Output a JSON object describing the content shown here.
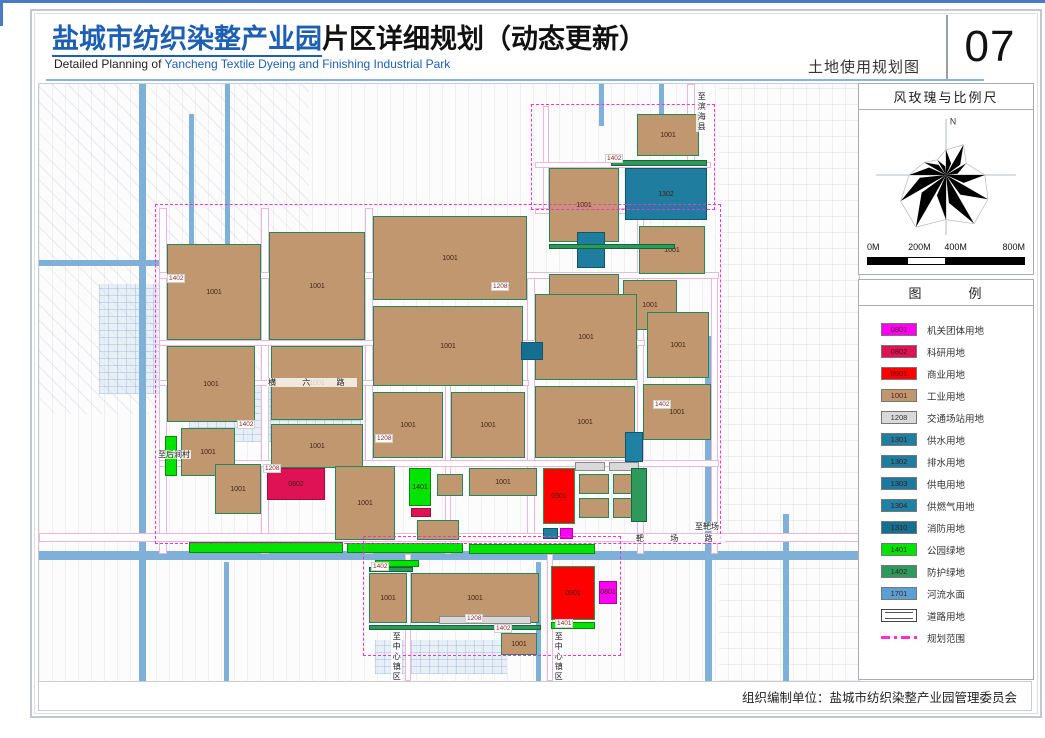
{
  "header": {
    "title_highlight": "盐城市纺织染整产业园",
    "title_rest": "片区详细规划（动态更新）",
    "subtitle_prefix": "Detailed Planning of ",
    "subtitle_highlight": "Yancheng Textile Dyeing and Finishing Industrial Park",
    "sheet_label": "土地使用规划图",
    "sheet_number": "07"
  },
  "windrose": {
    "title": "风玫瑰与比例尺",
    "north_label": "N",
    "scale_labels": [
      "0M",
      "200M",
      "400M",
      "800M"
    ],
    "petal_radii": [
      26,
      36,
      24,
      40,
      50,
      58,
      46,
      62,
      54,
      38,
      26,
      18
    ]
  },
  "legend": {
    "title": "图　　　例",
    "items": [
      {
        "code": "0801",
        "label": "机关团体用地",
        "color": "#ff00f0"
      },
      {
        "code": "0802",
        "label": "科研用地",
        "color": "#e01256"
      },
      {
        "code": "0901",
        "label": "商业用地",
        "color": "#ff0000"
      },
      {
        "code": "1001",
        "label": "工业用地",
        "color": "#c0976f"
      },
      {
        "code": "1208",
        "label": "交通场站用地",
        "color": "#d9d9d9"
      },
      {
        "code": "1301",
        "label": "供水用地",
        "color": "#207fa1"
      },
      {
        "code": "1302",
        "label": "排水用地",
        "color": "#1f7da0"
      },
      {
        "code": "1303",
        "label": "供电用地",
        "color": "#1d7a9e"
      },
      {
        "code": "1304",
        "label": "供燃气用地",
        "color": "#1f81a4"
      },
      {
        "code": "1310",
        "label": "消防用地",
        "color": "#156f90"
      },
      {
        "code": "1401",
        "label": "公园绿地",
        "color": "#00e400"
      },
      {
        "code": "1402",
        "label": "防护绿地",
        "color": "#2d9a5c"
      },
      {
        "code": "1701",
        "label": "河流水面",
        "color": "#5c9fd3"
      },
      {
        "code": "",
        "label": "道路用地",
        "type": "road"
      },
      {
        "code": "",
        "label": "规划范围",
        "type": "boundary"
      }
    ]
  },
  "map": {
    "colors": {
      "0801": "#ff00f0",
      "0802": "#e01256",
      "0901": "#ff0000",
      "1001": "#c0976f",
      "1208": "#d9d9d9",
      "1301": "#207fa1",
      "1302": "#1f7da0",
      "1303": "#1d7a9e",
      "1304": "#1f81a4",
      "1310": "#156f90",
      "1401": "#00e400",
      "1402": "#2d9a5c",
      "1701": "#5c9fd3"
    },
    "borders": {
      "1001": "#1f8a55",
      "1401": "#0a8a0a",
      "1402": "#14643c",
      "0901": "#17a24a",
      "0802": "#a50d42",
      "0801": "#b000b0",
      "1208": "#8a8a8a",
      "1301": "#0d566e",
      "1302": "#0d566e",
      "1303": "#0d566e",
      "1304": "#0d566e",
      "1310": "#0d566e",
      "1701": "#33709e"
    },
    "fields": [
      {
        "x": 0,
        "y": 0,
        "w": 270,
        "h": 330,
        "kind": "diag"
      },
      {
        "x": 680,
        "y": 0,
        "w": 140,
        "h": 597,
        "kind": "h"
      }
    ],
    "villages": [
      {
        "x": 150,
        "y": 302,
        "w": 172,
        "h": 56
      },
      {
        "x": 336,
        "y": 556,
        "w": 132,
        "h": 34
      },
      {
        "x": 60,
        "y": 200,
        "w": 60,
        "h": 110
      }
    ],
    "canals": [
      {
        "x": 100,
        "y": 0,
        "w": 7,
        "h": 597
      },
      {
        "x": 186,
        "y": 0,
        "w": 5,
        "h": 186
      },
      {
        "x": 0,
        "y": 176,
        "w": 190,
        "h": 6
      },
      {
        "x": 150,
        "y": 30,
        "w": 5,
        "h": 150
      },
      {
        "x": 0,
        "y": 467,
        "w": 820,
        "h": 9
      },
      {
        "x": 666,
        "y": 252,
        "w": 7,
        "h": 345
      },
      {
        "x": 744,
        "y": 430,
        "w": 6,
        "h": 167
      },
      {
        "x": 560,
        "y": 0,
        "w": 5,
        "h": 42
      },
      {
        "x": 620,
        "y": 0,
        "w": 5,
        "h": 62
      },
      {
        "x": 497,
        "y": 478,
        "w": 5,
        "h": 119
      },
      {
        "x": 185,
        "y": 478,
        "w": 5,
        "h": 119
      }
    ],
    "roads": [
      {
        "x": 648,
        "y": 0,
        "w": 8,
        "h": 134
      },
      {
        "x": 504,
        "y": 22,
        "w": 6,
        "h": 104
      },
      {
        "x": 496,
        "y": 78,
        "w": 176,
        "h": 6
      },
      {
        "x": 496,
        "y": 124,
        "w": 162,
        "h": 6
      },
      {
        "x": 120,
        "y": 124,
        "w": 8,
        "h": 346
      },
      {
        "x": 222,
        "y": 124,
        "w": 8,
        "h": 346
      },
      {
        "x": 326,
        "y": 124,
        "w": 8,
        "h": 346
      },
      {
        "x": 406,
        "y": 300,
        "w": 6,
        "h": 170
      },
      {
        "x": 488,
        "y": 190,
        "w": 8,
        "h": 280
      },
      {
        "x": 598,
        "y": 124,
        "w": 7,
        "h": 346
      },
      {
        "x": 672,
        "y": 190,
        "w": 7,
        "h": 280
      },
      {
        "x": 120,
        "y": 188,
        "w": 560,
        "h": 7
      },
      {
        "x": 120,
        "y": 256,
        "w": 486,
        "h": 6
      },
      {
        "x": 120,
        "y": 296,
        "w": 370,
        "h": 6
      },
      {
        "x": 120,
        "y": 376,
        "w": 560,
        "h": 7
      },
      {
        "x": 0,
        "y": 449,
        "w": 820,
        "h": 9
      },
      {
        "x": 366,
        "y": 470,
        "w": 6,
        "h": 127
      },
      {
        "x": 508,
        "y": 470,
        "w": 6,
        "h": 127
      }
    ],
    "boundary": [
      {
        "x": 116,
        "y": 120,
        "w": 566,
        "h": 340
      },
      {
        "x": 492,
        "y": 20,
        "w": 184,
        "h": 106
      },
      {
        "x": 324,
        "y": 452,
        "w": 258,
        "h": 120
      }
    ],
    "parcels": [
      {
        "c": "1001",
        "x": 598,
        "y": 30,
        "w": 62,
        "h": 42
      },
      {
        "c": "1402",
        "x": 572,
        "y": 76,
        "w": 96,
        "h": 6,
        "nl": 1
      },
      {
        "c": "1302",
        "x": 586,
        "y": 84,
        "w": 82,
        "h": 52
      },
      {
        "c": "1001",
        "x": 510,
        "y": 84,
        "w": 70,
        "h": 74
      },
      {
        "c": "1001",
        "x": 600,
        "y": 142,
        "w": 66,
        "h": 48
      },
      {
        "c": "1302",
        "x": 538,
        "y": 148,
        "w": 28,
        "h": 36,
        "nl": 1
      },
      {
        "c": "1402",
        "x": 510,
        "y": 160,
        "w": 126,
        "h": 5,
        "nl": 1
      },
      {
        "c": "1001",
        "x": 510,
        "y": 190,
        "w": 70,
        "h": 52
      },
      {
        "c": "1001",
        "x": 584,
        "y": 196,
        "w": 54,
        "h": 50
      },
      {
        "c": "1001",
        "x": 498,
        "y": 252,
        "w": 66,
        "h": 40
      },
      {
        "c": "1001",
        "x": 128,
        "y": 160,
        "w": 94,
        "h": 96
      },
      {
        "c": "1001",
        "x": 128,
        "y": 262,
        "w": 88,
        "h": 76
      },
      {
        "c": "1401",
        "x": 126,
        "y": 352,
        "w": 12,
        "h": 40,
        "nl": 1
      },
      {
        "c": "1001",
        "x": 142,
        "y": 344,
        "w": 54,
        "h": 48
      },
      {
        "c": "1001",
        "x": 230,
        "y": 148,
        "w": 96,
        "h": 108
      },
      {
        "c": "1001",
        "x": 334,
        "y": 132,
        "w": 154,
        "h": 84
      },
      {
        "c": "1001",
        "x": 334,
        "y": 222,
        "w": 150,
        "h": 80
      },
      {
        "c": "1001",
        "x": 496,
        "y": 210,
        "w": 102,
        "h": 86
      },
      {
        "c": "1310",
        "x": 482,
        "y": 258,
        "w": 22,
        "h": 18,
        "nl": 1
      },
      {
        "c": "1001",
        "x": 608,
        "y": 228,
        "w": 62,
        "h": 66
      },
      {
        "c": "1001",
        "x": 232,
        "y": 262,
        "w": 92,
        "h": 74
      },
      {
        "c": "1001",
        "x": 232,
        "y": 340,
        "w": 92,
        "h": 44
      },
      {
        "c": "1001",
        "x": 334,
        "y": 308,
        "w": 70,
        "h": 66
      },
      {
        "c": "1001",
        "x": 412,
        "y": 308,
        "w": 74,
        "h": 66
      },
      {
        "c": "1001",
        "x": 496,
        "y": 302,
        "w": 100,
        "h": 72
      },
      {
        "c": "1001",
        "x": 604,
        "y": 300,
        "w": 68,
        "h": 56
      },
      {
        "c": "1304",
        "x": 586,
        "y": 348,
        "w": 18,
        "h": 30,
        "nl": 1
      },
      {
        "c": "1001",
        "x": 176,
        "y": 380,
        "w": 46,
        "h": 50
      },
      {
        "c": "0802",
        "x": 228,
        "y": 384,
        "w": 58,
        "h": 32
      },
      {
        "c": "1001",
        "x": 296,
        "y": 382,
        "w": 60,
        "h": 74
      },
      {
        "c": "1401",
        "x": 370,
        "y": 384,
        "w": 22,
        "h": 38
      },
      {
        "c": "0802",
        "x": 372,
        "y": 424,
        "w": 20,
        "h": 9,
        "nl": 1
      },
      {
        "c": "1001",
        "x": 398,
        "y": 390,
        "w": 26,
        "h": 22,
        "nl": 1
      },
      {
        "c": "1001",
        "x": 430,
        "y": 384,
        "w": 68,
        "h": 28
      },
      {
        "c": "1001",
        "x": 378,
        "y": 436,
        "w": 42,
        "h": 20,
        "nl": 1
      },
      {
        "c": "0901",
        "x": 504,
        "y": 384,
        "w": 32,
        "h": 56
      },
      {
        "c": "1301",
        "x": 504,
        "y": 444,
        "w": 15,
        "h": 11,
        "nl": 1
      },
      {
        "c": "0801",
        "x": 521,
        "y": 444,
        "w": 13,
        "h": 11,
        "nl": 1
      },
      {
        "c": "1001",
        "x": 540,
        "y": 390,
        "w": 30,
        "h": 20,
        "nl": 1
      },
      {
        "c": "1001",
        "x": 574,
        "y": 390,
        "w": 28,
        "h": 20,
        "nl": 1
      },
      {
        "c": "1001",
        "x": 540,
        "y": 414,
        "w": 30,
        "h": 20,
        "nl": 1
      },
      {
        "c": "1001",
        "x": 574,
        "y": 414,
        "w": 28,
        "h": 20,
        "nl": 1
      },
      {
        "c": "1208",
        "x": 536,
        "y": 378,
        "w": 30,
        "h": 9,
        "nl": 1
      },
      {
        "c": "1208",
        "x": 570,
        "y": 378,
        "w": 30,
        "h": 9,
        "nl": 1
      },
      {
        "c": "1402",
        "x": 592,
        "y": 384,
        "w": 16,
        "h": 54,
        "nl": 1
      },
      {
        "c": "1401",
        "x": 150,
        "y": 458,
        "w": 154,
        "h": 11,
        "nl": 1
      },
      {
        "c": "1401",
        "x": 308,
        "y": 459,
        "w": 116,
        "h": 10,
        "nl": 1
      },
      {
        "c": "1401",
        "x": 430,
        "y": 460,
        "w": 126,
        "h": 10,
        "nl": 1
      },
      {
        "c": "1401",
        "x": 336,
        "y": 476,
        "w": 44,
        "h": 7,
        "nl": 1
      },
      {
        "c": "1402",
        "x": 330,
        "y": 483,
        "w": 44,
        "h": 5,
        "nl": 1
      },
      {
        "c": "1001",
        "x": 330,
        "y": 489,
        "w": 38,
        "h": 50
      },
      {
        "c": "1001",
        "x": 372,
        "y": 489,
        "w": 128,
        "h": 50
      },
      {
        "c": "1208",
        "x": 400,
        "y": 532,
        "w": 92,
        "h": 8,
        "nl": 1
      },
      {
        "c": "1402",
        "x": 330,
        "y": 541,
        "w": 172,
        "h": 5,
        "nl": 1
      },
      {
        "c": "1001",
        "x": 462,
        "y": 549,
        "w": 36,
        "h": 22
      },
      {
        "c": "0901",
        "x": 512,
        "y": 482,
        "w": 44,
        "h": 54
      },
      {
        "c": "0801",
        "x": 560,
        "y": 497,
        "w": 18,
        "h": 23
      },
      {
        "c": "1401",
        "x": 512,
        "y": 538,
        "w": 44,
        "h": 7,
        "nl": 1
      }
    ],
    "labels": [
      {
        "t": "至滨海县",
        "x": 657,
        "y": 8,
        "v": 1
      },
      {
        "t": "至后涧村",
        "x": 118,
        "y": 366
      },
      {
        "t": "横  六  路",
        "x": 228,
        "y": 294,
        "sp": 1
      },
      {
        "t": "靶  场  路",
        "x": 596,
        "y": 450,
        "sp": 1
      },
      {
        "t": "至靶场",
        "x": 655,
        "y": 438
      },
      {
        "t": "至中心镇区",
        "x": 352,
        "y": 548,
        "v": 1
      },
      {
        "t": "至中心镇区",
        "x": 514,
        "y": 548,
        "v": 1
      },
      {
        "t": "1402",
        "x": 566,
        "y": 70,
        "chip": 1
      },
      {
        "t": "1402",
        "x": 128,
        "y": 190,
        "chip": 1
      },
      {
        "t": "1402",
        "x": 198,
        "y": 336,
        "chip": 1
      },
      {
        "t": "1402",
        "x": 332,
        "y": 478,
        "chip": 1
      },
      {
        "t": "1402",
        "x": 455,
        "y": 540,
        "chip": 1
      },
      {
        "t": "1402",
        "x": 614,
        "y": 316,
        "chip": 1
      },
      {
        "t": "1208",
        "x": 452,
        "y": 198,
        "chip": 1
      },
      {
        "t": "1208",
        "x": 224,
        "y": 380,
        "chip": 1
      },
      {
        "t": "1208",
        "x": 426,
        "y": 530,
        "chip": 1
      },
      {
        "t": "1208",
        "x": 336,
        "y": 350,
        "chip": 1
      },
      {
        "t": "1401",
        "x": 516,
        "y": 535,
        "chip": 1
      }
    ]
  },
  "footer": {
    "text": "组织编制单位：盐城市纺织染整产业园管理委员会"
  }
}
